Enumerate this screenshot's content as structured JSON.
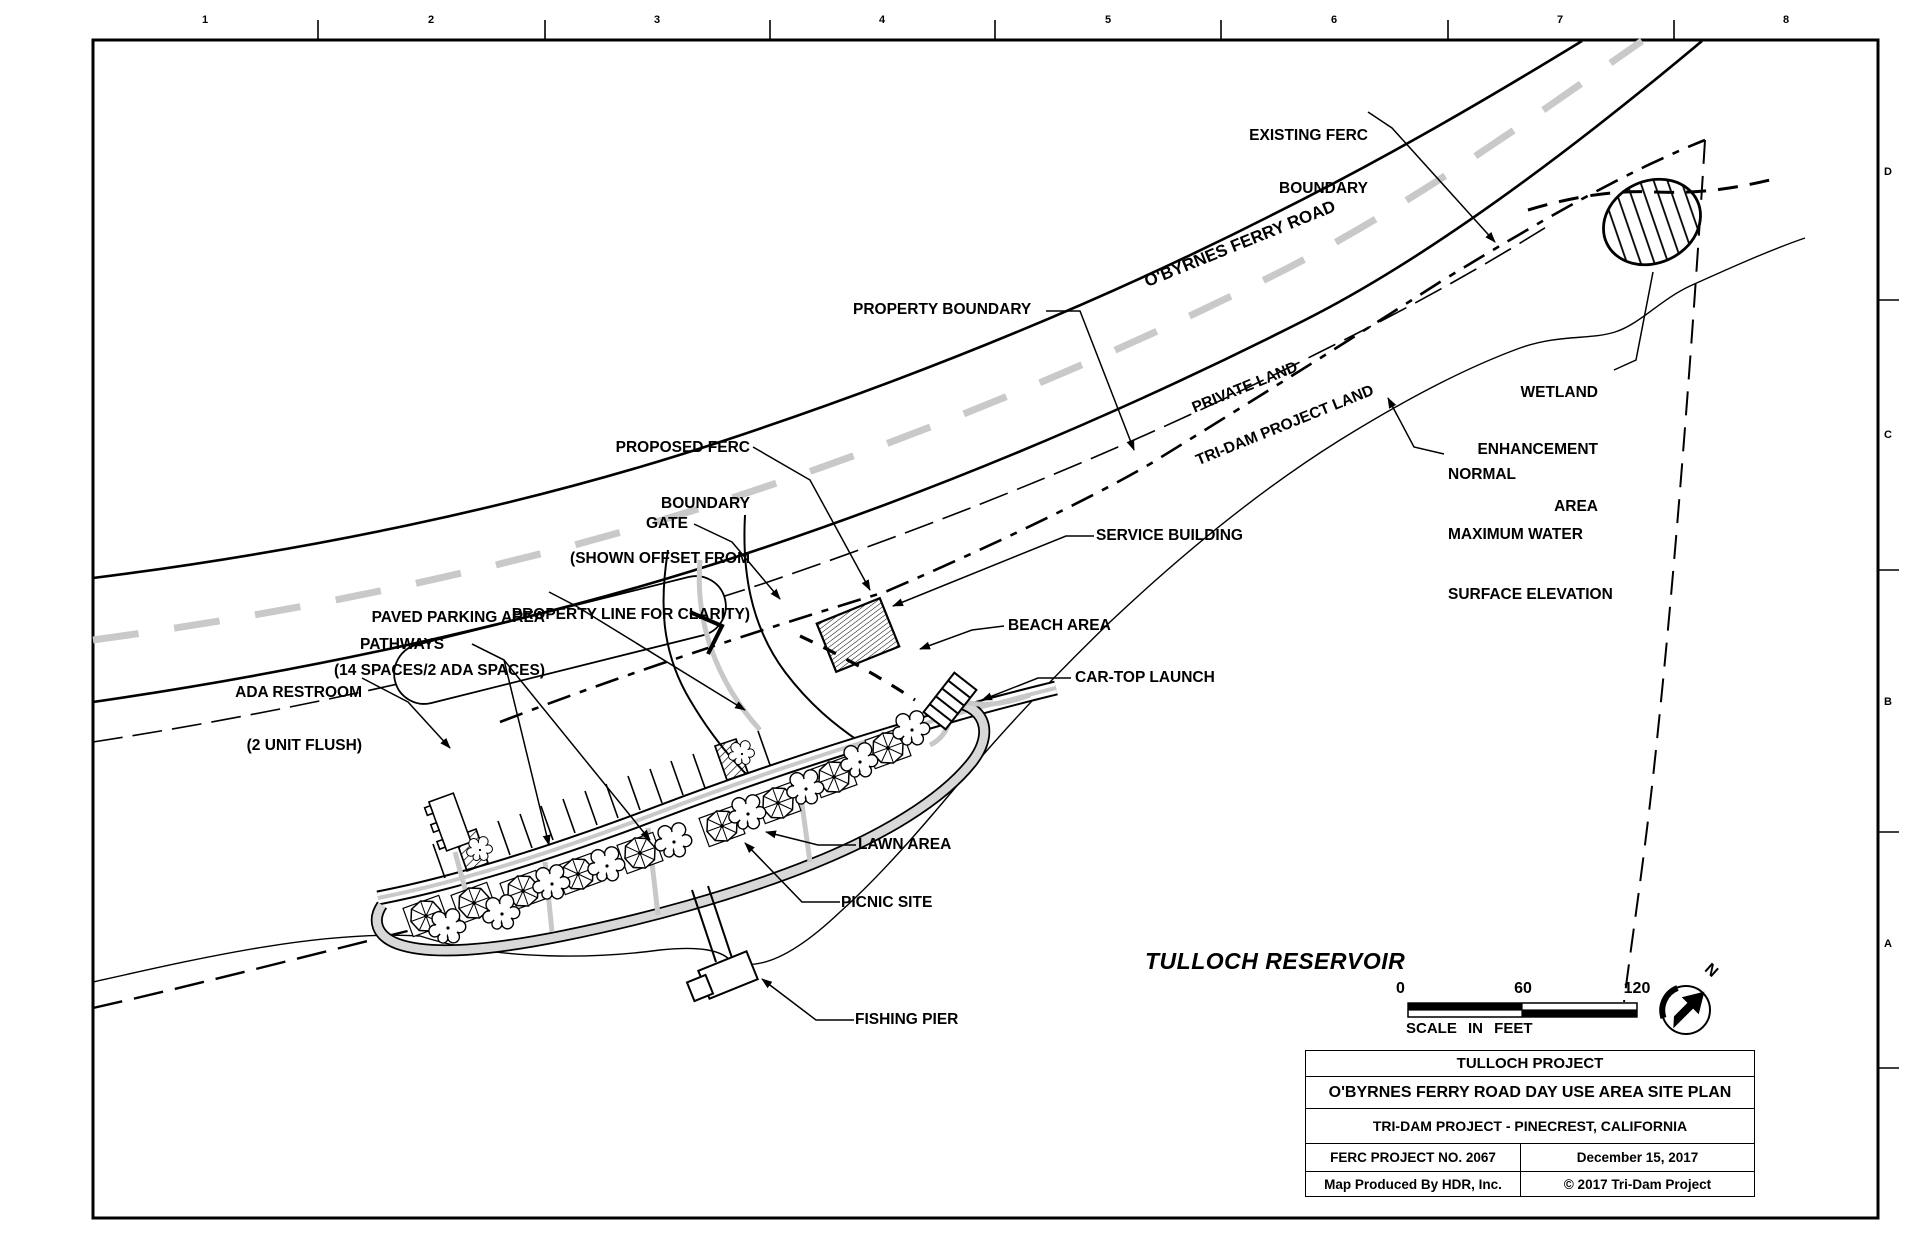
{
  "ruler": {
    "numbers": [
      "1",
      "2",
      "3",
      "4",
      "5",
      "6",
      "7",
      "8"
    ]
  },
  "grid_letters": [
    "D",
    "C",
    "B",
    "A"
  ],
  "labels": {
    "existing_ferc": {
      "lines": [
        "EXISTING FERC",
        "BOUNDARY"
      ]
    },
    "property_boundary": {
      "text": "PROPERTY BOUNDARY"
    },
    "road_name": {
      "text": "O'BYRNES FERRY ROAD"
    },
    "private_land": {
      "text": "PRIVATE LAND"
    },
    "tridam_land": {
      "text": "TRI-DAM PROJECT LAND"
    },
    "wetland": {
      "lines": [
        "WETLAND",
        "ENHANCEMENT",
        "AREA"
      ]
    },
    "normal_max": {
      "lines": [
        "NORMAL",
        "MAXIMUM WATER",
        "SURFACE ELEVATION"
      ]
    },
    "proposed_ferc": {
      "lines": [
        "PROPOSED FERC",
        "BOUNDARY",
        "(SHOWN OFFSET FROM",
        "PROPERTY LINE FOR CLARITY)"
      ]
    },
    "gate": {
      "text": "GATE"
    },
    "service_building": {
      "text": "SERVICE BUILDING"
    },
    "paved_parking": {
      "lines": [
        "PAVED PARKING AREA",
        "(14 SPACES/2 ADA SPACES)"
      ]
    },
    "pathways": {
      "text": "PATHWAYS"
    },
    "ada_restroom": {
      "lines": [
        "ADA RESTROOM",
        "(2 UNIT FLUSH)"
      ]
    },
    "beach_area": {
      "text": "BEACH AREA"
    },
    "car_top_launch": {
      "text": "CAR-TOP LAUNCH"
    },
    "lawn_area": {
      "text": "LAWN AREA"
    },
    "picnic_site": {
      "text": "PICNIC SITE"
    },
    "fishing_pier": {
      "text": "FISHING PIER"
    },
    "reservoir": {
      "text": "TULLOCH RESERVOIR"
    }
  },
  "scale_bar": {
    "tick0": "0",
    "tick60": "60",
    "tick120": "120",
    "caption": "SCALE IN FEET"
  },
  "north": {
    "letter": "N"
  },
  "title_block": {
    "row1": "TULLOCH PROJECT",
    "row2": "O'BYRNES FERRY ROAD DAY USE AREA SITE PLAN",
    "row3": "TRI-DAM PROJECT - PINECREST, CALIFORNIA",
    "row4_left": "FERC PROJECT NO. 2067",
    "row4_right": "December 15, 2017",
    "row5_left": "Map Produced By HDR, Inc.",
    "row5_right": "© 2017 Tri-Dam Project"
  },
  "colors": {
    "ink": "#000000",
    "road_center_gray": "#c9c9c9",
    "path_gray": "#c8c8c8"
  }
}
